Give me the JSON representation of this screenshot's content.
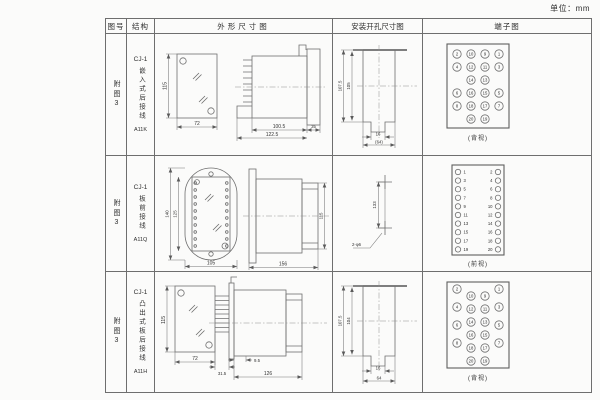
{
  "unit_label": "单位：mm",
  "colors": {
    "ink": "#2f2f2f",
    "line": "#6f6f6f",
    "background": "#fbfbfa"
  },
  "header": {
    "figure": "图号",
    "structure": "结构",
    "outline": "外形尺寸图",
    "install": "安装开孔尺寸图",
    "terminal": "端子图"
  },
  "rows": [
    {
      "figure": "附图3",
      "model": "CJ-1",
      "structure": "嵌入式后接线",
      "code": "A11K",
      "outline": {
        "front_h": "115",
        "front_w": "72",
        "len1": "100.5",
        "flange": "35",
        "len2": "122.5"
      },
      "install": {
        "h_outer": "107.5",
        "h_inner": "105",
        "w_slot": "16",
        "w_open": "(64)"
      },
      "terminal": {
        "view": "(背视)",
        "type": "quad",
        "stagger": false,
        "cols": {
          "outer_left": [
            "2",
            "4",
            "6",
            "8"
          ],
          "inner_left": [
            "10",
            "12",
            "14",
            "16",
            "18",
            "20"
          ],
          "inner_right": [
            "9",
            "11",
            "13",
            "15",
            "17",
            "19"
          ],
          "outer_right": [
            "1",
            "3",
            "5",
            "7"
          ]
        }
      }
    },
    {
      "figure": "附图3",
      "model": "CJ-1",
      "structure": "板前接线",
      "code": "A11Q",
      "outline": {
        "front_h": "140",
        "front_h2": "125",
        "front_w": "105",
        "side_len": "156",
        "side_h": "115"
      },
      "install": {
        "pitch": "133",
        "hole": "2-φ6"
      },
      "terminal": {
        "view": "(前视)",
        "type": "twocol",
        "cols": {
          "left": [
            "1",
            "3",
            "5",
            "7",
            "9",
            "11",
            "13",
            "15",
            "17",
            "19"
          ],
          "right": [
            "2",
            "4",
            "6",
            "8",
            "10",
            "12",
            "14",
            "16",
            "18",
            "20"
          ]
        }
      }
    },
    {
      "figure": "附图3",
      "model": "CJ-1",
      "structure": "凸出式板后接线",
      "code": "A11H",
      "outline": {
        "front_h": "115",
        "front_w": "72",
        "offset": "9.5",
        "pin_len": "31.5",
        "len": "126"
      },
      "install": {
        "h_outer": "107.5",
        "h_inner": "104",
        "w_slot": "16",
        "w_open": "64"
      },
      "terminal": {
        "view": "(背视)",
        "type": "quad",
        "stagger": true,
        "cols": {
          "outer_left": [
            "2",
            "4",
            "6",
            "8"
          ],
          "inner_left": [
            "10",
            "12",
            "14",
            "16",
            "18",
            "20"
          ],
          "inner_right": [
            "9",
            "11",
            "13",
            "15",
            "17",
            "19"
          ],
          "outer_right": [
            "1",
            "3",
            "5",
            "7"
          ]
        }
      }
    }
  ]
}
